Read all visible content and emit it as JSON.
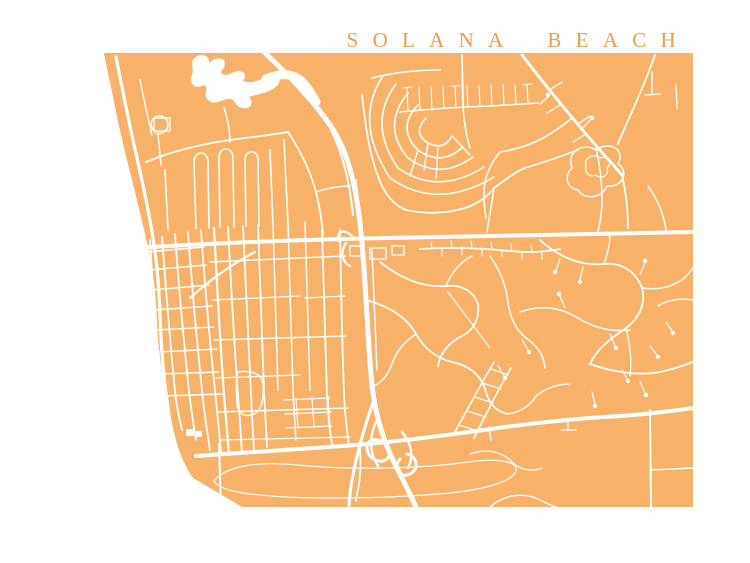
{
  "page": {
    "background_color": "#ffffff"
  },
  "title": {
    "text": "SOLANA BEACH",
    "color": "#E99C4D"
  },
  "map": {
    "land_color": "#F7B169",
    "road_color": "#FFFFFF",
    "viewbox": "0 0 750 563",
    "land_path": "M104,53 L693,53 L693,507 L242,507 L193,478 C186,468 180,455 176,440 C172,424 168,408 165,390 C161,368 158,345 157,322 C156,298 154,275 149,252 C144,228 137,200 130,172 C123,145 117,118 112,92 C108,72 105,60 104,53 Z",
    "water": [
      {
        "name": "lagoon",
        "d": "M193,60 C198,52 210,54 209,63 C218,55 228,58 224,68 C217,74 224,77 232,73 C241,68 249,73 243,81 C250,84 259,81 266,77 C275,72 283,76 278,85 C270,93 258,94 249,97 C255,103 250,110 242,108 C234,106 236,98 228,99 C220,100 214,106 208,100 C202,94 210,89 204,85 C196,90 188,84 192,75 C194,70 191,65 193,60 Z"
      }
    ],
    "water_strokes": [
      {
        "d": "M266,79 C278,74 290,72 300,80 C308,87 312,95 316,102",
        "w": 9
      }
    ],
    "roads": [
      {
        "d": "M262,50 C285,72 312,98 332,128 C348,152 355,185 359,215 C363,245 364,270 366,300 C368,330 369,355 372,385 C375,412 382,438 394,462 C402,478 410,494 416,507",
        "w": 5
      },
      {
        "d": "M330,128 C344,155 350,185 353,215",
        "w": 2
      },
      {
        "d": "M356,180 L360,215",
        "w": 1.5
      },
      {
        "d": "M346,243 C340,252 342,262 350,266",
        "w": 2.2
      },
      {
        "d": "M352,236 C344,228 336,232 338,241",
        "w": 2.2
      },
      {
        "d": "M381,441 C369,436 363,446 370,456 C377,464 389,463 390,452",
        "w": 3
      },
      {
        "d": "M400,459 C392,469 400,479 410,474 C420,469 417,456 407,454",
        "w": 3
      },
      {
        "d": "M402,432 C412,444 414,456 408,468",
        "w": 2.5
      },
      {
        "d": "M377,420 C369,436 369,452 378,466",
        "w": 2.5
      },
      {
        "d": "M374,400 C364,428 356,458 352,480 C350,492 349,500 349,507",
        "w": 3.2
      },
      {
        "d": "M116,57 C121,82 126,108 133,140 C140,172 148,205 153,238 C157,262 159,288 160,315 C161,348 164,380 168,408 C171,432 176,452 183,470 C188,480 196,490 206,498",
        "w": 3.2
      },
      {
        "d": "M133,248 C200,244 270,241 340,239 C420,237 480,236 540,235 C600,234 650,233 693,232",
        "w": 4
      },
      {
        "d": "M196,456 C250,452 305,449 355,445 C405,441 455,434 505,427 C550,421 585,418 620,416 C650,414 672,411 693,408",
        "w": 4
      },
      {
        "d": "M150,240 C153,290 156,340 162,390 C164,405 166,418 168,428",
        "w": 1.8
      },
      {
        "d": "M162,237 C166,290 170,345 176,400 C178,412 180,422 182,430",
        "w": 1.8
      },
      {
        "d": "M175,234 C179,290 184,345 190,400 C192,414 194,428 196,440",
        "w": 1.8
      },
      {
        "d": "M188,232 C192,288 197,344 203,400 C205,418 208,436 210,450",
        "w": 1.8
      },
      {
        "d": "M201,230 C205,288 210,344 216,400 C218,420 220,440 221,452",
        "w": 1.8
      },
      {
        "d": "M146,252 L204,247",
        "w": 1.5
      },
      {
        "d": "M149,270 L206,265",
        "w": 1.5
      },
      {
        "d": "M152,290 L209,285",
        "w": 1.5
      },
      {
        "d": "M154,310 L212,306",
        "w": 1.5
      },
      {
        "d": "M156,330 L214,327",
        "w": 1.5
      },
      {
        "d": "M158,352 L217,349",
        "w": 1.5
      },
      {
        "d": "M161,374 L219,372",
        "w": 1.5
      },
      {
        "d": "M165,396 L222,394",
        "w": 1.5
      },
      {
        "d": "M214,228 C217,285 220,340 224,395 C226,420 228,442 229,455",
        "w": 2.2
      },
      {
        "d": "M228,227 C231,285 234,340 238,395 C240,420 241,440 242,453",
        "w": 1.8
      },
      {
        "d": "M243,226 C246,285 248,340 251,395 C252,415 253,435 254,450",
        "w": 1.8
      },
      {
        "d": "M258,225 C260,280 262,335 264,390 C265,410 266,430 267,447",
        "w": 1.8
      },
      {
        "d": "M273,224 C275,280 276,335 278,390",
        "w": 1.5
      },
      {
        "d": "M288,223 C290,280 291,335 293,390 C294,410 295,425 296,440",
        "w": 1.5
      },
      {
        "d": "M305,222 C307,280 308,335 310,390",
        "w": 1.5
      },
      {
        "d": "M322,230 C324,285 325,340 327,395 C328,415 330,432 332,445",
        "w": 1.8
      },
      {
        "d": "M340,230 C341,285 342,340 344,395 C345,415 347,432 349,445",
        "w": 1.8
      },
      {
        "d": "M210,262 L345,256",
        "w": 1.5
      },
      {
        "d": "M212,300 L300,296",
        "w": 1.3
      },
      {
        "d": "M305,298 L345,296",
        "w": 1.3
      },
      {
        "d": "M214,340 L346,336",
        "w": 1.5
      },
      {
        "d": "M216,378 L300,375",
        "w": 1.3
      },
      {
        "d": "M218,412 L348,408",
        "w": 1.5
      },
      {
        "d": "M220,440 L350,437",
        "w": 1.3
      },
      {
        "d": "M190,298 C210,280 232,264 255,252",
        "w": 2.2
      },
      {
        "d": "M146,162 C175,150 210,142 245,138 C262,136 276,134 288,132",
        "w": 1.8
      },
      {
        "d": "M196,228 L194,162 C194,150 208,150 208,162 L209,228",
        "w": 1.6
      },
      {
        "d": "M220,227 L219,158 C219,146 233,146 233,158 L234,227",
        "w": 1.6
      },
      {
        "d": "M246,226 L245,160 C245,149 258,149 258,160 L259,226",
        "w": 1.6
      },
      {
        "d": "M270,150 L273,225",
        "w": 1.6
      },
      {
        "d": "M284,140 L288,224",
        "w": 1.6
      },
      {
        "d": "M165,170 L168,230",
        "w": 1.6
      },
      {
        "d": "M152,128 C148,118 160,112 166,119 C172,126 164,136 156,133 Z",
        "w": 1.5
      },
      {
        "d": "M158,134 L161,165",
        "w": 1.4
      },
      {
        "d": "M224,108 C228,120 230,132 230,142",
        "w": 1.6
      },
      {
        "d": "M288,132 C300,150 310,170 316,192 C320,208 322,222 323,235",
        "w": 1.8
      },
      {
        "d": "M316,192 C328,188 340,186 350,186",
        "w": 1.4
      },
      {
        "d": "M140,80 C144,100 148,118 152,135",
        "w": 1.4
      },
      {
        "d": "M426,118 Q412,133 428,143 Q444,151 452,136",
        "w": 1.6
      },
      {
        "d": "M418,105 Q396,128 418,150 Q441,167 463,147",
        "w": 1.6
      },
      {
        "d": "M408,93 Q381,126 408,158 Q440,181 473,157",
        "w": 1.6
      },
      {
        "d": "M396,84 Q367,123 398,168 Q438,196 484,167",
        "w": 1.6
      },
      {
        "d": "M383,76 Q353,121 390,178 Q437,211 494,177",
        "w": 1.6
      },
      {
        "d": "M428,143 L424,170",
        "w": 1.4
      },
      {
        "d": "M452,136 L470,155",
        "w": 1.4
      },
      {
        "d": "M418,150 L410,176",
        "w": 1.4
      },
      {
        "d": "M438,148 L436,178",
        "w": 1.3
      },
      {
        "d": "M372,78 C395,72 418,70 440,70",
        "w": 1.6
      },
      {
        "d": "M362,95 C366,130 370,160 382,186 C388,198 396,206 406,210",
        "w": 1.8
      },
      {
        "d": "M406,210 C425,214 445,214 465,208 C478,204 488,196 494,188 C505,180 515,172 525,168",
        "w": 1.8
      },
      {
        "d": "M494,188 C492,204 489,218 487,232",
        "w": 1.6
      },
      {
        "d": "M525,168 C545,162 562,156 578,150",
        "w": 1.5
      },
      {
        "d": "M400,112 C430,109 460,107 490,106 C506,105 522,104 538,103",
        "w": 1.6
      },
      {
        "d": "M408,111 L407,88",
        "w": 1.2
      },
      {
        "d": "M420,110 L419,88",
        "w": 1.2
      },
      {
        "d": "M432,110 L431,87",
        "w": 1.2
      },
      {
        "d": "M444,109 L443,87",
        "w": 1.2
      },
      {
        "d": "M456,108 L455,86",
        "w": 1.2
      },
      {
        "d": "M468,107 L467,86",
        "w": 1.2
      },
      {
        "d": "M480,107 L479,86",
        "w": 1.2
      },
      {
        "d": "M492,106 L491,85",
        "w": 1.2
      },
      {
        "d": "M504,105 L503,85",
        "w": 1.2
      },
      {
        "d": "M516,104 L515,85",
        "w": 1.2
      },
      {
        "d": "M528,104 L527,84",
        "w": 1.2
      },
      {
        "d": "M403,88 L412,87",
        "w": 1.1
      },
      {
        "d": "M451,86 L460,86",
        "w": 1.1
      },
      {
        "d": "M523,85 L532,84",
        "w": 1.1
      },
      {
        "d": "M462,55 L463,106",
        "w": 1.8
      },
      {
        "d": "M463,106 C464,122 466,135 470,148",
        "w": 1.6
      },
      {
        "d": "M522,55 C545,85 572,118 598,148 C608,159 616,168 622,175",
        "w": 2.8
      },
      {
        "d": "M549,90 L562,82",
        "w": 1.3
      },
      {
        "d": "M560,105 L547,113",
        "w": 1.3
      },
      {
        "d": "M578,124 L590,116",
        "w": 1.3
      },
      {
        "d": "M586,134 L573,142",
        "w": 1.3
      },
      {
        "d": "M655,55 C648,75 639,96 630,116 C626,125 622,134 618,144",
        "w": 1.8
      },
      {
        "d": "M652,72 L652,95",
        "w": 1.4
      },
      {
        "d": "M645,95 L660,94",
        "w": 1.2
      },
      {
        "d": "M676,85 L677,108",
        "w": 1.3
      },
      {
        "d": "M572,168 C566,152 582,142 596,150 C610,140 626,150 618,164 C630,172 622,188 607,186 C602,199 584,200 578,190 C566,188 564,176 572,168 Z",
        "w": 1.5
      },
      {
        "d": "M586,165 C584,157 594,153 600,158 C608,155 613,163 607,168 C610,175 601,180 596,175 C589,178 584,172 586,165 Z",
        "w": 1.2
      },
      {
        "d": "M622,175 C626,192 628,210 628,228",
        "w": 1.8
      },
      {
        "d": "M596,148 C600,165 602,182 602,200 C602,212 600,222 598,232",
        "w": 1.6
      },
      {
        "d": "M572,118 C560,128 548,136 535,142 C524,147 512,150 500,152",
        "w": 1.6
      },
      {
        "d": "M500,152 C492,162 487,172 485,182 C483,194 484,206 486,218",
        "w": 1.5
      },
      {
        "d": "M648,186 C658,200 664,216 666,230",
        "w": 1.5
      },
      {
        "d": "M420,249 C450,247 480,248 510,251 C528,253 545,252 560,249",
        "w": 1.8
      },
      {
        "d": "M432,248 L431,242",
        "w": 1.1
      },
      {
        "d": "M442,248 L442,256",
        "w": 1.1
      },
      {
        "d": "M452,247 L451,241",
        "w": 1.1
      },
      {
        "d": "M462,247 L462,255",
        "w": 1.1
      },
      {
        "d": "M472,247 L471,241",
        "w": 1.1
      },
      {
        "d": "M482,248 L482,256",
        "w": 1.1
      },
      {
        "d": "M492,249 L491,242",
        "w": 1.1
      },
      {
        "d": "M502,250 L502,257",
        "w": 1.1
      },
      {
        "d": "M512,251 L511,244",
        "w": 1.1
      },
      {
        "d": "M522,252 L522,259",
        "w": 1.1
      },
      {
        "d": "M532,252 L531,245",
        "w": 1.1
      },
      {
        "d": "M542,252 L542,259",
        "w": 1.1
      },
      {
        "d": "M372,250 C374,290 375,330 377,370",
        "w": 1.5
      },
      {
        "d": "M380,262 C400,278 422,288 446,286 C462,284 474,292 478,304",
        "w": 1.8
      },
      {
        "d": "M478,304 C480,318 474,330 462,336 C448,343 440,354 438,366",
        "w": 1.8
      },
      {
        "d": "M366,300 C388,306 406,316 416,334 C424,348 436,358 452,362",
        "w": 1.8
      },
      {
        "d": "M452,362 C470,366 482,376 486,392 C489,404 497,412 508,414",
        "w": 1.8
      },
      {
        "d": "M448,292 L490,348",
        "w": 1.1
      },
      {
        "d": "M490,256 C500,270 506,286 508,302 C510,318 516,330 526,338",
        "w": 1.5
      },
      {
        "d": "M526,338 C538,346 544,356 545,368",
        "w": 1.5
      },
      {
        "d": "M446,286 C452,272 460,262 472,256",
        "w": 1.4
      },
      {
        "d": "M416,334 C404,342 396,352 392,364 C388,376 380,384 370,388",
        "w": 1.5
      },
      {
        "d": "M455,432 C468,408 481,384 494,362",
        "w": 1.6
      },
      {
        "d": "M474,438 C486,414 498,390 511,368",
        "w": 1.6
      },
      {
        "d": "M459,425 L478,431",
        "w": 1.2
      },
      {
        "d": "M467,411 L486,417",
        "w": 1.2
      },
      {
        "d": "M475,397 L493,403",
        "w": 1.2
      },
      {
        "d": "M483,383 L501,389",
        "w": 1.2
      },
      {
        "d": "M491,369 L508,375",
        "w": 1.2
      },
      {
        "d": "M508,414 C520,412 530,406 536,396",
        "w": 1.5
      },
      {
        "d": "M536,396 C546,388 558,384 570,384",
        "w": 1.4
      },
      {
        "d": "M540,240 C560,258 582,266 604,264 C622,262 636,272 642,288 C646,302 640,318 626,328 C610,339 596,350 590,364",
        "w": 1.8
      },
      {
        "d": "M520,312 C542,304 562,308 578,318 C594,328 612,332 630,330",
        "w": 1.5
      },
      {
        "d": "M590,364 C612,372 638,376 660,372 C674,369 685,365 693,362",
        "w": 1.8
      },
      {
        "d": "M642,288 C656,290 668,288 678,282",
        "w": 1.4
      },
      {
        "d": "M678,282 C686,278 690,272 693,268",
        "w": 1.4
      },
      {
        "d": "M626,328 C630,344 632,360 630,376",
        "w": 1.3
      },
      {
        "d": "M693,300 C680,298 668,300 658,306",
        "w": 1.4
      },
      {
        "d": "M604,264 C608,252 610,244 610,236",
        "w": 1.3
      },
      {
        "d": "M219,444 L221,507",
        "w": 2
      },
      {
        "d": "M360,448 C361,466 360,480 358,490 C357,494 356,498 356,501",
        "w": 1.8
      },
      {
        "d": "M214,481 C226,466 256,461 298,465 C348,470 420,469 468,462 C498,458 518,461 516,471 C512,483 478,491 438,494 C390,498 330,499 286,497 C252,495 220,492 214,481 Z",
        "w": 1.2
      },
      {
        "d": "M650,410 L651,507",
        "w": 2
      },
      {
        "d": "M651,470 L693,468",
        "w": 1.5
      },
      {
        "d": "M470,454 C488,448 502,452 512,462 C520,470 532,472 542,468",
        "w": 1.3
      },
      {
        "d": "M490,507 C505,494 525,492 540,500 C548,504 552,506 556,507",
        "w": 1.5
      },
      {
        "d": "M568,420 L568,430",
        "w": 1.3
      },
      {
        "d": "M561,430 L576,430",
        "w": 1.3
      },
      {
        "d": "M489,427 L491,440",
        "w": 1.3
      },
      {
        "d": "M284,400 L330,398",
        "w": 1.3
      },
      {
        "d": "M285,414 L331,412",
        "w": 1.3
      },
      {
        "d": "M286,428 L332,426",
        "w": 1.3
      },
      {
        "d": "M296,398 L298,428",
        "w": 1.2
      },
      {
        "d": "M312,397 L314,427",
        "w": 1.2
      },
      {
        "d": "M328,396 L330,426",
        "w": 1.2
      },
      {
        "d": "M238,372 C252,370 262,374 263,384 C264,398 262,410 254,414 C246,418 238,414 237,404 C236,392 236,378 238,372 Z",
        "w": 1.4
      },
      {
        "d": "M556,270 L560,259",
        "w": 1.2
      },
      {
        "d": "M580,280 L583,267",
        "w": 1.2
      },
      {
        "d": "M560,296 L565,308",
        "w": 1.2
      },
      {
        "d": "M615,346 L610,334",
        "w": 1.2
      },
      {
        "d": "M657,355 L650,346",
        "w": 1.2
      },
      {
        "d": "M645,263 L640,274",
        "w": 1.2
      },
      {
        "d": "M595,404 L592,392",
        "w": 1.2
      },
      {
        "d": "M645,393 L640,382",
        "w": 1.2
      },
      {
        "d": "M504,376 L498,366",
        "w": 1.2
      },
      {
        "d": "M528,350 L522,340",
        "w": 1.2
      },
      {
        "d": "M672,331 L666,322",
        "w": 1.2
      },
      {
        "d": "M627,379 L622,370",
        "w": 1.2
      },
      {
        "d": "M548,97 L540,104",
        "w": 1.2
      },
      {
        "d": "M590,120 L583,128",
        "w": 1.2
      }
    ],
    "rects": [
      {
        "x": 154,
        "y": 118,
        "w": 16,
        "h": 13,
        "filled": false,
        "sw": 1.4
      },
      {
        "x": 350,
        "y": 246,
        "w": 14,
        "h": 10,
        "filled": false,
        "sw": 1.3
      },
      {
        "x": 370,
        "y": 248,
        "w": 16,
        "h": 11,
        "filled": false,
        "sw": 1.3
      },
      {
        "x": 392,
        "y": 246,
        "w": 12,
        "h": 9,
        "filled": false,
        "sw": 1.3
      },
      {
        "x": 186,
        "y": 429,
        "w": 8,
        "h": 7,
        "filled": true,
        "sw": 0
      },
      {
        "x": 196,
        "y": 431,
        "w": 6,
        "h": 6,
        "filled": true,
        "sw": 0
      }
    ],
    "dots": [
      {
        "x": 555,
        "y": 272,
        "r": 2.2
      },
      {
        "x": 580,
        "y": 282,
        "r": 2.2
      },
      {
        "x": 559,
        "y": 294,
        "r": 2.2
      },
      {
        "x": 616,
        "y": 348,
        "r": 2.2
      },
      {
        "x": 658,
        "y": 357,
        "r": 2.2
      },
      {
        "x": 645,
        "y": 261,
        "r": 2.2
      },
      {
        "x": 595,
        "y": 406,
        "r": 2.2
      },
      {
        "x": 646,
        "y": 395,
        "r": 2.2
      },
      {
        "x": 505,
        "y": 378,
        "r": 2.2
      },
      {
        "x": 529,
        "y": 352,
        "r": 2.2
      },
      {
        "x": 673,
        "y": 333,
        "r": 2.2
      },
      {
        "x": 628,
        "y": 381,
        "r": 2.2
      },
      {
        "x": 548,
        "y": 95,
        "r": 2.2
      },
      {
        "x": 592,
        "y": 118,
        "r": 2.2
      }
    ]
  }
}
